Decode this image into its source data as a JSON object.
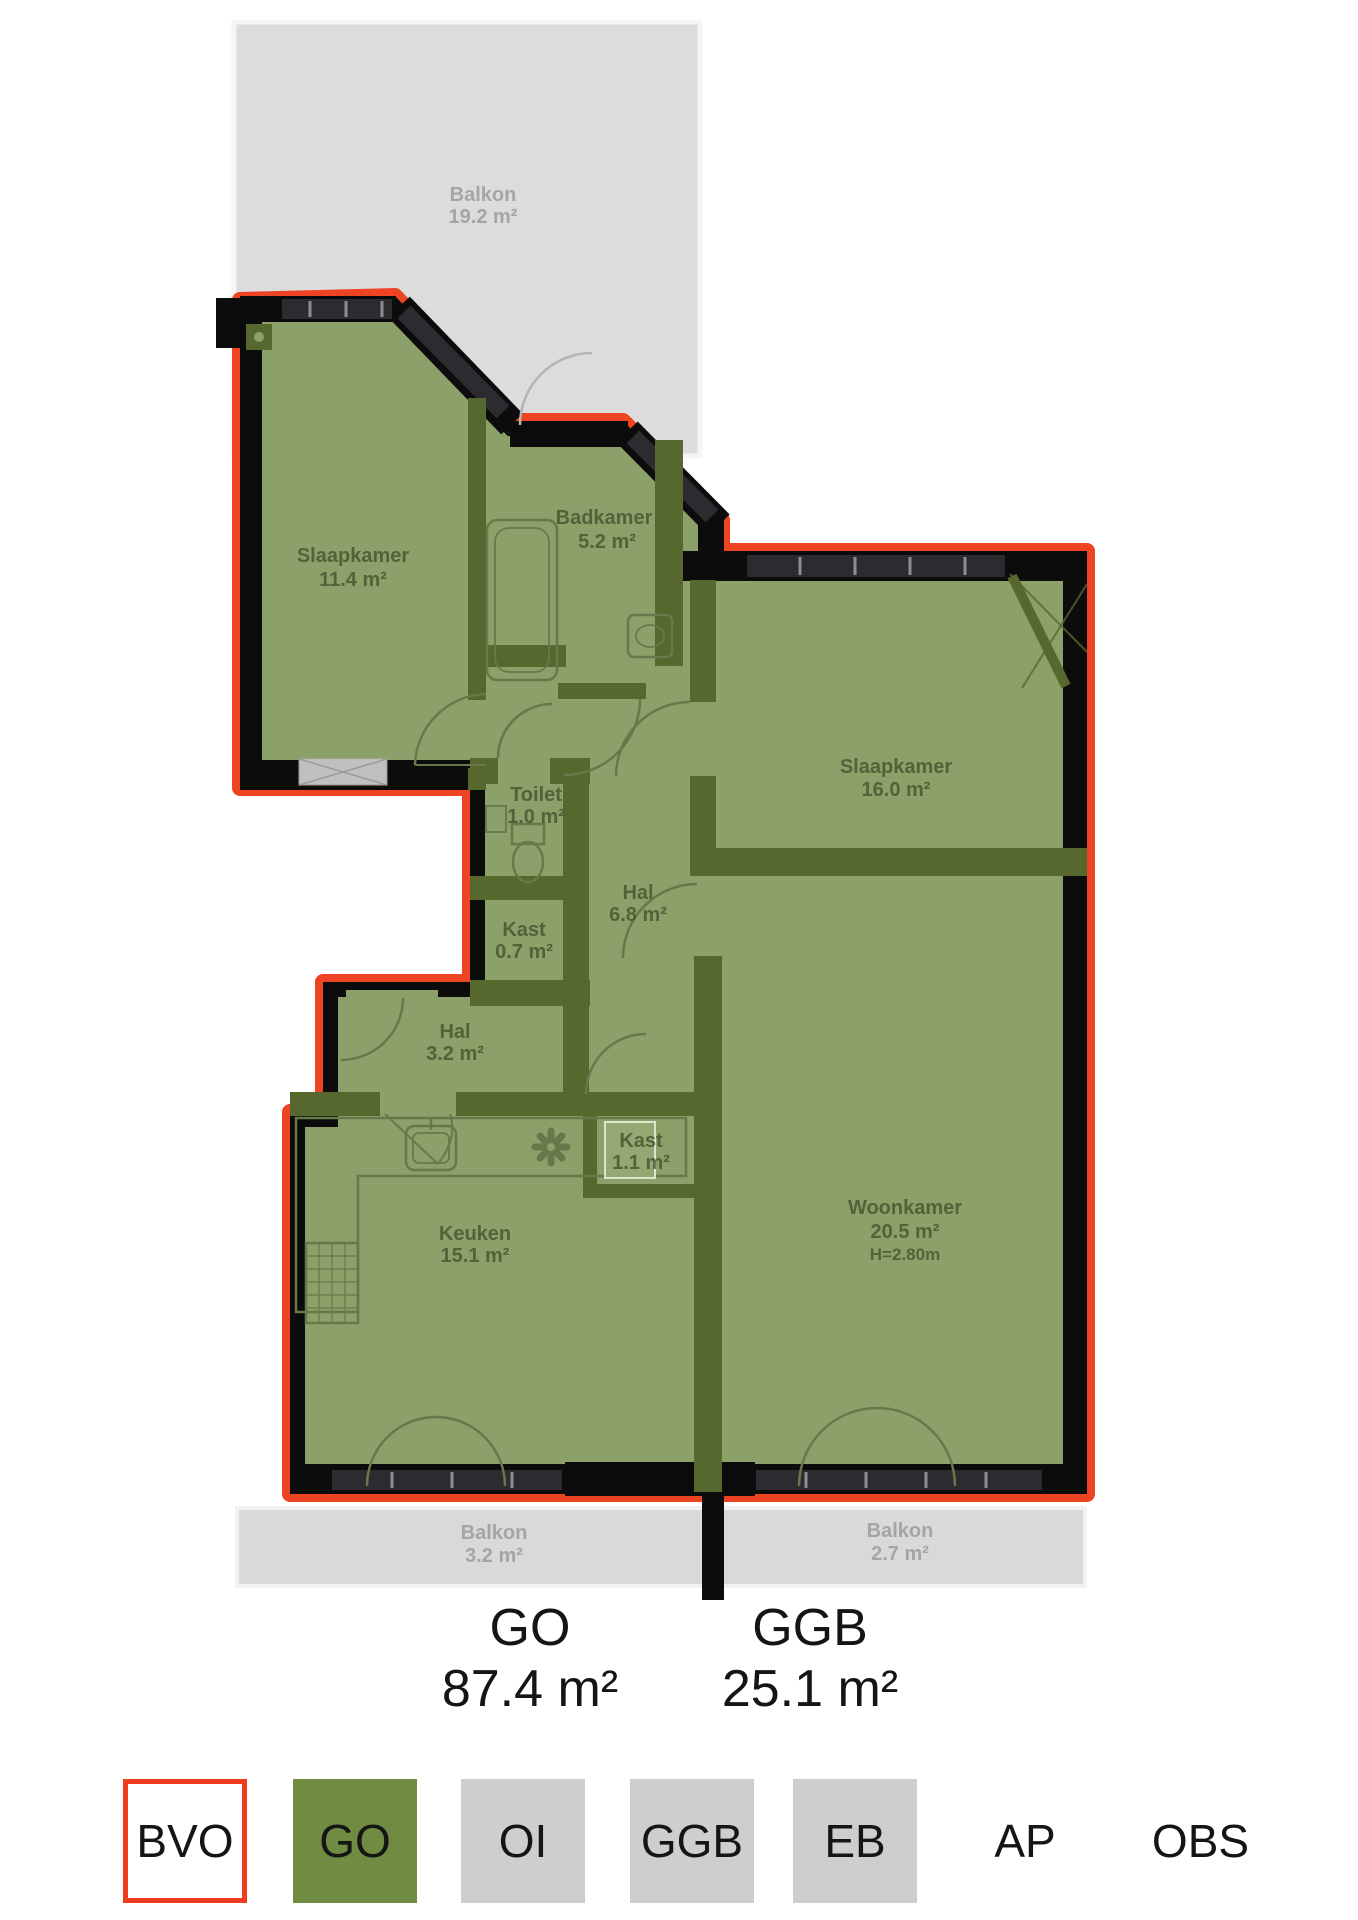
{
  "plan": {
    "balconies": [
      {
        "name": "Balkon",
        "area": "19.2 m²"
      },
      {
        "name": "Balkon",
        "area": "3.2 m²"
      },
      {
        "name": "Balkon",
        "area": "2.7 m²"
      }
    ],
    "rooms": [
      {
        "name": "Slaapkamer",
        "area": "11.4 m²"
      },
      {
        "name": "Badkamer",
        "area": "5.2 m²"
      },
      {
        "name": "Toilet",
        "area": "1.0 m²"
      },
      {
        "name": "Hal",
        "area": "6.8 m²"
      },
      {
        "name": "Kast",
        "area": "0.7 m²"
      },
      {
        "name": "Slaapkamer",
        "area": "16.0 m²"
      },
      {
        "name": "Hal",
        "area": "3.2 m²"
      },
      {
        "name": "Kast",
        "area": "1.1 m²"
      },
      {
        "name": "Keuken",
        "area": "15.1 m²"
      },
      {
        "name": "Woonkamer",
        "area": "20.5 m²",
        "height": "H=2.80m"
      }
    ]
  },
  "summary": {
    "items": [
      {
        "label": "GO",
        "value": "87.4 m²"
      },
      {
        "label": "GGB",
        "value": "25.1 m²"
      }
    ]
  },
  "legend": {
    "items": [
      {
        "label": "BVO"
      },
      {
        "label": "GO"
      },
      {
        "label": "OI"
      },
      {
        "label": "GGB"
      },
      {
        "label": "EB"
      },
      {
        "label": "AP"
      },
      {
        "label": "OBS"
      }
    ]
  },
  "colors": {
    "bvo_outline": "#ee4424",
    "go_fill": "#8ca069",
    "interior_wall": "#57682f",
    "exterior_wall": "#0c0c0c",
    "balcony_fill": "#d9d9d9",
    "legend_go": "#6f8c42",
    "legend_gray": "#cecece"
  }
}
